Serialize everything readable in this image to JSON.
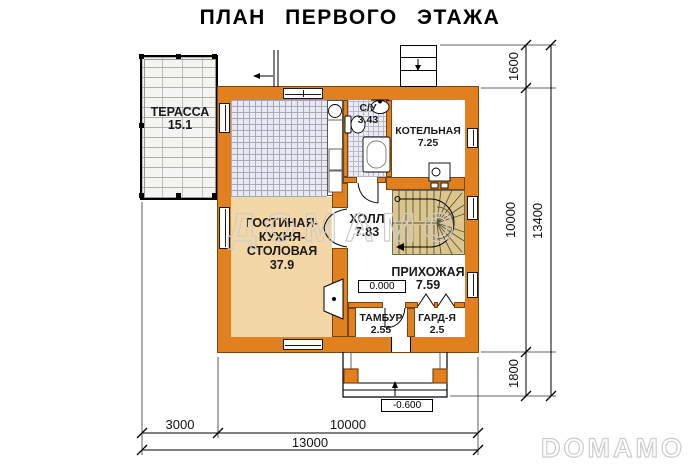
{
  "title": "ПЛАН ПЕРВОГО ЭТАЖА",
  "rooms": {
    "terrace": {
      "name": "ТЕРАССА",
      "area": "15.1"
    },
    "living": {
      "name_line1": "ГОСТИНАЯ-",
      "name_line2": "КУХНЯ-",
      "name_line3": "СТОЛОВАЯ",
      "area": "37.9"
    },
    "bathroom": {
      "name": "С/У",
      "area": "3.43"
    },
    "boiler": {
      "name": "КОТЕЛЬНАЯ",
      "area": "7.25"
    },
    "hall": {
      "name": "ХОЛЛ",
      "area": "7.83"
    },
    "entry_hall": {
      "name": "ПРИХОЖАЯ",
      "area": "7.59"
    },
    "vestibule": {
      "name": "ТАМБУР",
      "area": "2.55"
    },
    "wardrobe": {
      "name": "ГАРД-Я",
      "area": "2.5"
    }
  },
  "levels": {
    "ground": "0.000",
    "porch": "-0.600"
  },
  "dimensions": {
    "right": [
      "1600",
      "10000",
      "1800"
    ],
    "right_total": "13400",
    "bottom": [
      "3000",
      "10000"
    ],
    "bottom_total": "13000"
  },
  "watermarks": {
    "center": "ДОМАМО",
    "corner": "DOMAMO"
  },
  "colors": {
    "wall_orange": "#e0801e",
    "wall_outline": "#7a4510",
    "living_floor_peach": "#f4d7a6",
    "stairs_tan": "#dcc68c",
    "tile_fill": "#e9e9f1"
  }
}
